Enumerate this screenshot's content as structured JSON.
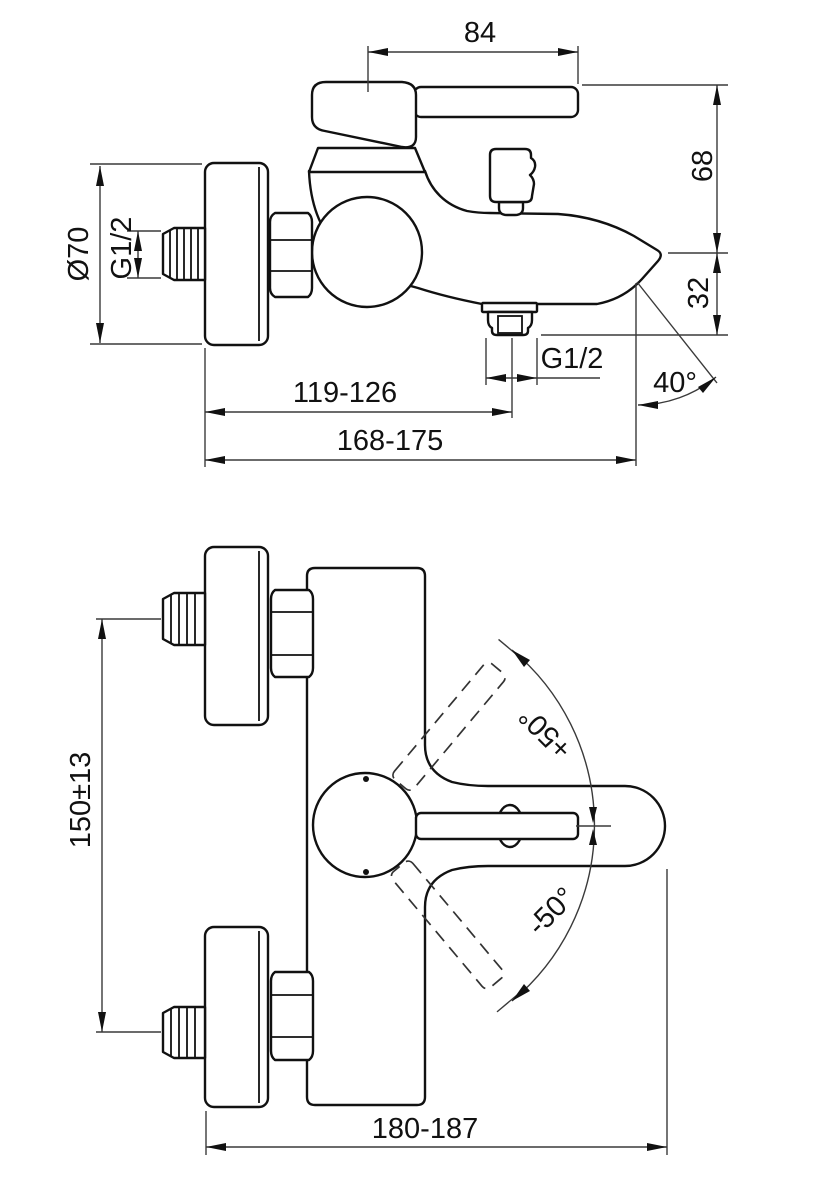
{
  "drawing": {
    "background_color": "#ffffff",
    "line_color": "#111111",
    "side_view": {
      "handle_reach": "84",
      "upper_height": "68",
      "spout_drop": "32",
      "escutcheon_diameter": "Ø70",
      "inlet_thread": "G1/2",
      "outlet_thread": "G1/2",
      "wall_to_outlet_center": "119-126",
      "wall_to_spout_tip": "168-175",
      "spray_angle": "40°"
    },
    "front_view": {
      "inlet_span": "150±13",
      "handle_swing_up": "+50°",
      "handle_swing_down": "-50°",
      "overall_width": "180-187"
    }
  }
}
